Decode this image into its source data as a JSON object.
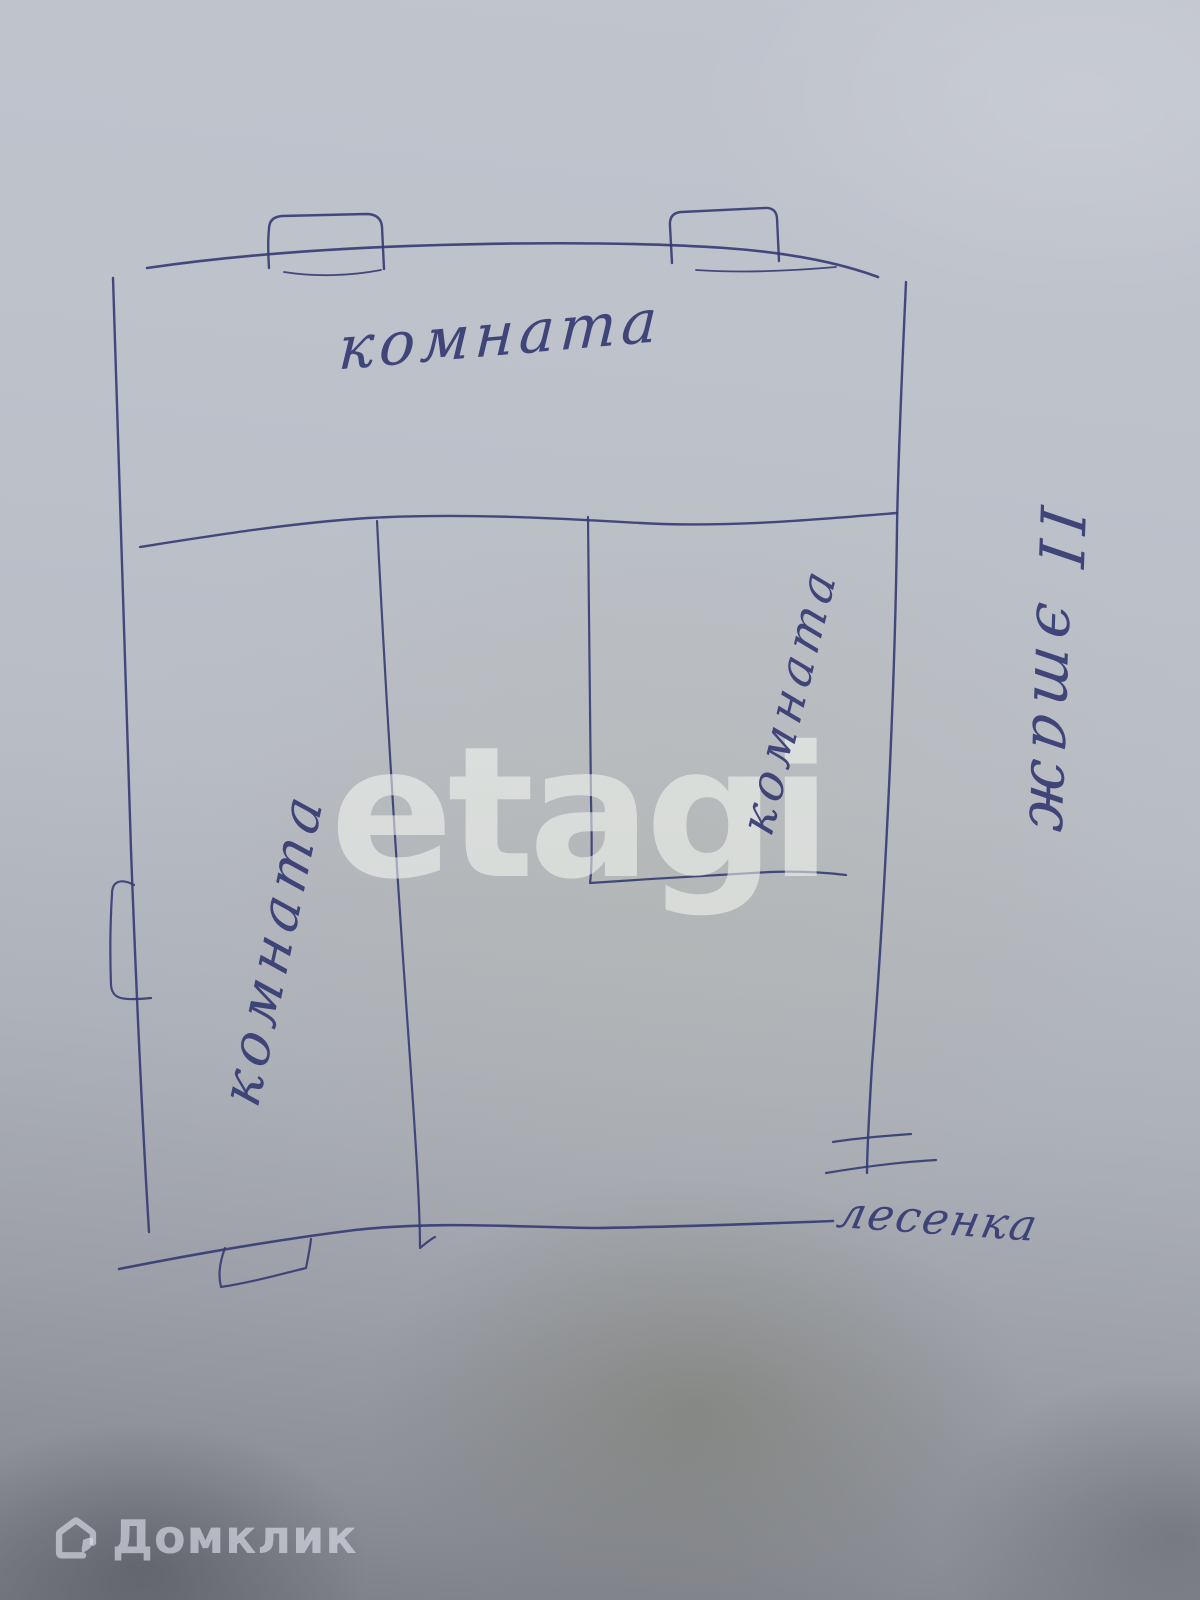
{
  "photo": {
    "paper_color_top": "#bfc3cc",
    "paper_color_bottom": "#7c7e87",
    "ink_color": "#353b73"
  },
  "plan": {
    "room_top_label": "комната",
    "room_left_label": "комната",
    "room_right_label": "комната",
    "floor_label": "II этаж",
    "stairs_label": "лесенка"
  },
  "watermarks": {
    "etagi": "etagi",
    "domclick": "Домклик"
  }
}
